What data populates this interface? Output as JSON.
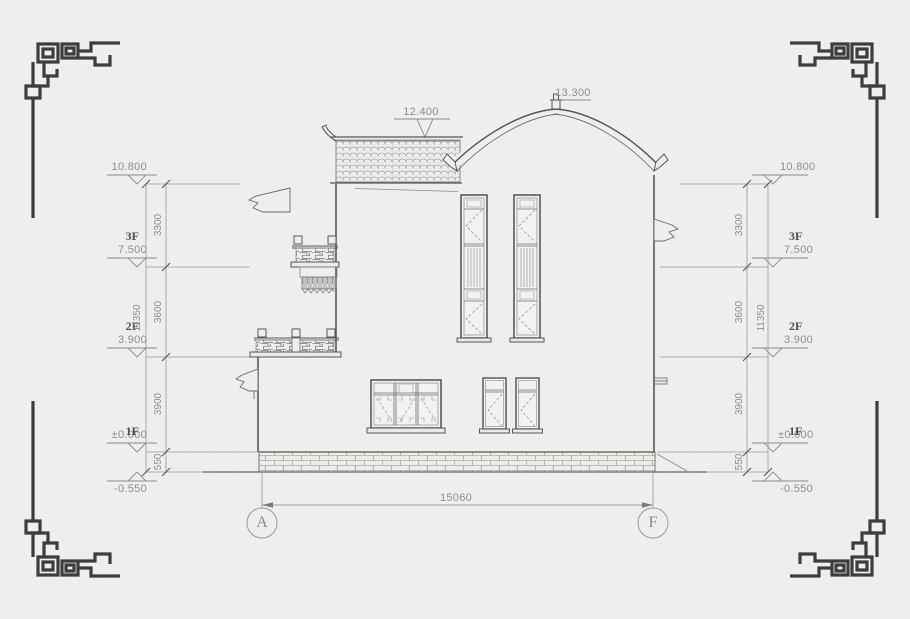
{
  "drawing": {
    "type": "building side elevation",
    "levels": {
      "ridge": "13.300",
      "roof_flat": "12.400",
      "parapet": "10.800",
      "f3": "7.500",
      "f2": "3.900",
      "f1": "±0.000",
      "ground": "-0.550"
    },
    "floor_labels": {
      "f3": "3F",
      "f2": "2F",
      "f1": "1F"
    },
    "dimensions": {
      "parapet_to_f3": "3300",
      "f3_to_f2": "3600",
      "f2_to_f1": "3900",
      "f1_to_ground": "550",
      "vertical_total": "11350",
      "horizontal_total": "15060"
    },
    "grid_axes": {
      "left": "A",
      "right": "F"
    }
  }
}
